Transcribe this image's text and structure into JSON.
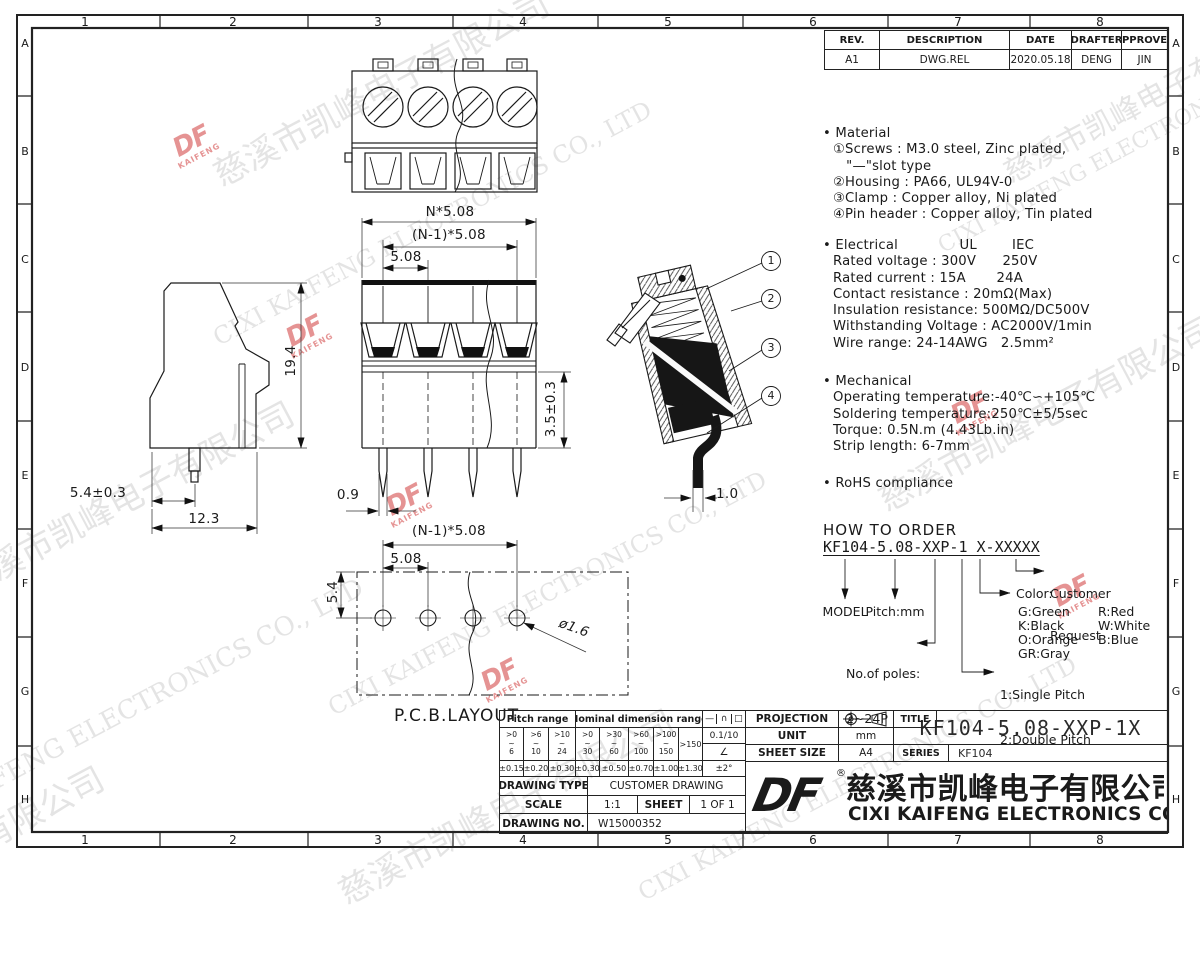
{
  "sheet": {
    "cols": [
      "1",
      "2",
      "3",
      "4",
      "5",
      "6",
      "7",
      "8"
    ],
    "rows": [
      "A",
      "B",
      "C",
      "D",
      "E",
      "F",
      "G",
      "H"
    ]
  },
  "watermark": {
    "logo_main": "DF",
    "logo_sub": "KAIFENG",
    "strips": [
      "慈溪市凯峰电子有限公司",
      "CIXI KAIFENG ELECTRONICS CO., LTD",
      "KAIFENG ELECTRONICS CO., LTD"
    ]
  },
  "revision_table": {
    "headers": [
      "REV.",
      "DESCRIPTION",
      "DATE",
      "DRAFTER",
      "APPROVER"
    ],
    "row": [
      "A1",
      "DWG.REL",
      "2020.05.18",
      "DENG",
      "JIN"
    ]
  },
  "specs": {
    "material_title": "• Material",
    "material_lines": [
      "①Screws : M3.0 steel, Zinc plated,",
      "   \"—\"slot type",
      "②Housing : PA66, UL94V-0",
      "③Clamp : Copper alloy, Ni plated",
      "④Pin header : Copper alloy, Tin plated"
    ],
    "electrical_title": "• Electrical              UL        IEC",
    "electrical_lines": [
      "Rated voltage : 300V      250V",
      "Rated current : 15A       24A",
      "Contact resistance : 20mΩ(Max)",
      "Insulation resistance: 500MΩ/DC500V",
      "Withstanding Voltage : AC2000V/1min",
      "Wire range: 24-14AWG   2.5mm²"
    ],
    "mechanical_title": "• Mechanical",
    "mechanical_lines": [
      "Operating temperature:-40℃∽+105℃",
      "Soldering temperature:250℃±5/5sec",
      "Torque: 0.5N.m (4.43Lb.in)",
      "Strip length: 6-7mm"
    ],
    "rohs": "• RoHS compliance"
  },
  "how_to_order": {
    "title": "HOW TO ORDER",
    "code": "KF104-5.08-XXP-1 X-XXXXX",
    "model": "MODEL",
    "pitch": "Pitch:mm",
    "poles_line1": "No.of poles:",
    "poles_line2": "2~24P",
    "pitch_type_line1": "1:Single Pitch",
    "pitch_type_line2": "2:Double Pitch",
    "color_label": "Color:",
    "colors": [
      "G:Green",
      "R:Red",
      "K:Black",
      "W:White",
      "O:Orange",
      "B:Blue",
      "GR:Gray"
    ],
    "customer_line1": "Customer",
    "customer_line2": "Request"
  },
  "dims": {
    "front_total": "N*5.08",
    "front_span": "(N-1)*5.08",
    "front_pitch": "5.08",
    "front_pin_w": "0.9",
    "front_h": "3.5±0.3",
    "side_h": "19.4",
    "side_pin": "5.4±0.3",
    "side_w": "12.3",
    "pcb_span": "(N-1)*5.08",
    "pcb_pitch": "5.08",
    "pcb_edge": "5.4",
    "pcb_hole": "ø1.6",
    "section_pin": "1.0"
  },
  "pcb_label": "P.C.B.LAYOUT",
  "callouts": [
    "1",
    "2",
    "3",
    "4"
  ],
  "tolerance": {
    "pitch_header": "Pitch range",
    "nominal_header": "Nominal dimension range",
    "symbols": [
      "—",
      "∩",
      "□"
    ],
    "ranges": [
      [
        ">0",
        "~",
        "6"
      ],
      [
        ">6",
        "~",
        "10"
      ],
      [
        ">10",
        "~",
        "24"
      ],
      [
        ">0",
        "~",
        "30"
      ],
      [
        ">30",
        "~",
        "60"
      ],
      [
        ">60",
        "~",
        "100"
      ],
      [
        ">100",
        "~",
        "150"
      ]
    ],
    "range_last": ">150",
    "flatness": "0.1/10",
    "angle_symbol": "∠",
    "tolerances": [
      "±0.15",
      "±0.20",
      "±0.30",
      "±0.30",
      "±0.50",
      "±0.70",
      "±1.00",
      "±1.30"
    ],
    "angle_tol": "±2°"
  },
  "title_block": {
    "drawing_type_label": "DRAWING TYPE",
    "drawing_type": "CUSTOMER DRAWING",
    "scale_label": "SCALE",
    "scale": "1:1",
    "sheet_label": "SHEET",
    "sheet": "1 OF 1",
    "drawing_no_label": "DRAWING NO.",
    "drawing_no": "W15000352",
    "projection_label": "PROJECTION",
    "unit_label": "UNIT",
    "unit": "mm",
    "sheet_size_label": "SHEET SIZE",
    "sheet_size": "A4",
    "title_label": "TITLE",
    "title": "KF104-5.08-XXP-1X",
    "series_label": "SERIES",
    "series": "KF104"
  },
  "company": {
    "logo": "DF",
    "registered": "®",
    "name_cn": "慈溪市凯峰电子有限公司",
    "name_en": "CIXI KAIFENG ELECTRONICS CO.,LTD"
  }
}
